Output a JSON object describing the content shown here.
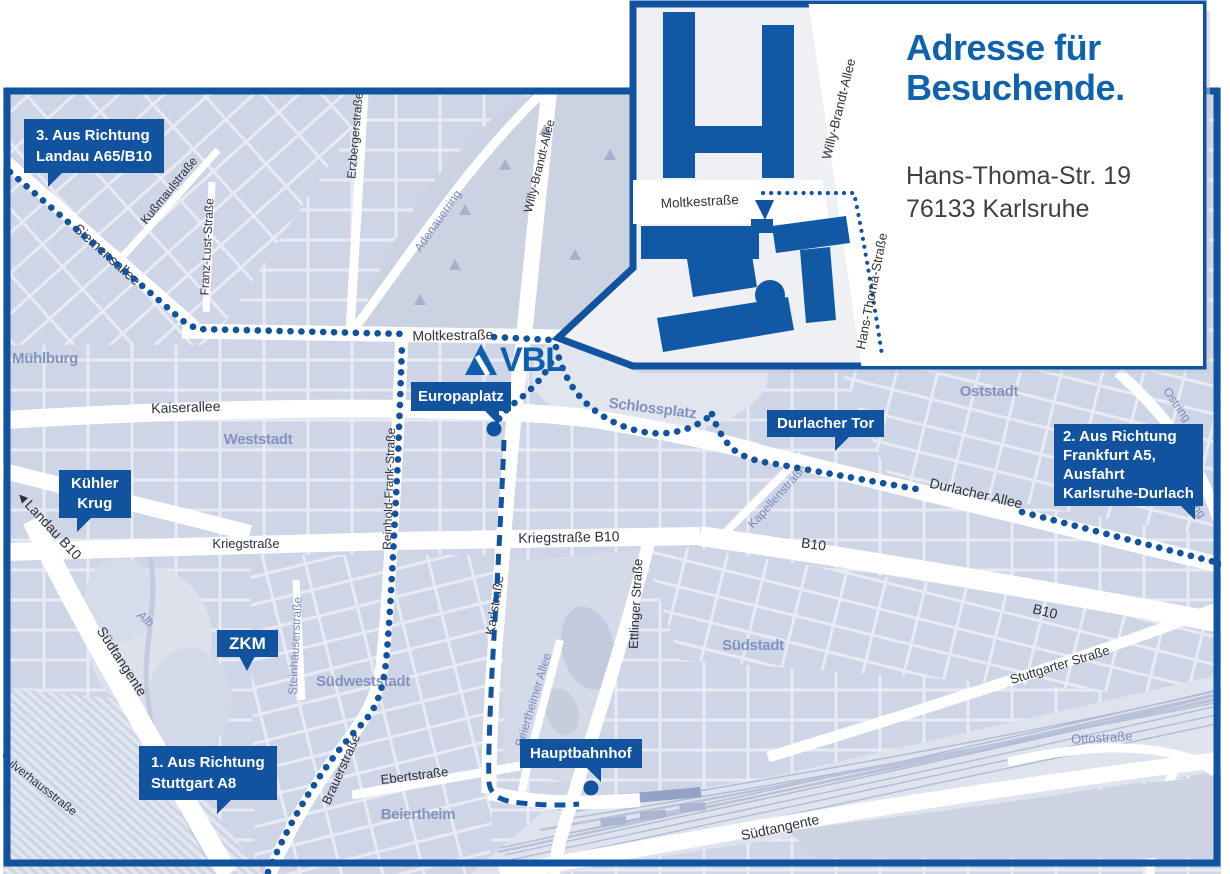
{
  "inset": {
    "title": {
      "line1": "Adresse für",
      "line2": "Besuchende."
    },
    "address": {
      "line1": "Hans-Thoma-Str. 19",
      "line2": "76133 Karlsruhe"
    },
    "streets": {
      "moltkestrasse": "Moltkestraße",
      "willy_brandt_allee": "Willy-Brandt-Allee",
      "hans_thoma_strasse": "Hans-Thoma-Straße"
    }
  },
  "logo": {
    "text": "VBL"
  },
  "callouts": {
    "landau": {
      "line1": "3. Aus Richtung",
      "line2": "Landau A65/B10"
    },
    "frankfurt": {
      "line1": "2. Aus Richtung",
      "line2": "Frankfurt A5,",
      "line3": "Ausfahrt",
      "line4": "Karlsruhe-Durlach"
    },
    "stuttgart": {
      "line1": "1. Aus Richtung",
      "line2": "Stuttgart A8"
    },
    "kuehler_krug": {
      "line1": "Kühler",
      "line2": "Krug"
    },
    "zkm": {
      "label": "ZKM"
    },
    "europaplatz": {
      "label": "Europaplatz"
    },
    "durlacher_tor": {
      "label": "Durlacher Tor"
    },
    "hauptbahnhof": {
      "label": "Hauptbahnhof"
    }
  },
  "streets": {
    "moltkestrasse": "Moltkestraße",
    "kaiserallee": "Kaiserallee",
    "siemensallee": "Siemensallee",
    "kussmaulstrasse": "Kußmaulstraße",
    "franz_lust_strasse": "Franz-Lust-Straße",
    "erzbergerstrasse": "Erzbergerstraße",
    "willy_brandt_allee": "Willy-Brandt-Allee",
    "adenauerring": "Adenauerring",
    "reinhold_frank_strasse": "Reinhold-Frank-Straße",
    "kriegstrasse": "Kriegstraße",
    "kriegstrasse_b10": "Kriegstraße B10",
    "karlstrasse": "Karlstraße",
    "ettlinger_strasse": "Ettlinger Straße",
    "beiertheimer_allee": "Beiertheimer Allee",
    "steinhaeuserstrasse": "Steinhäuserstraße",
    "brauerstrasse": "Brauerstraße",
    "ebertstrasse": "Ebertstraße",
    "suedtangente": "Südtangente",
    "stuttgarter_strasse": "Stuttgarter Straße",
    "durlacher_allee": "Durlacher Allee",
    "kapellenstrasse": "Kapellenstraße",
    "landau_b10": "◄Landau B10",
    "b10": "B10",
    "ostring": "Ostring",
    "ottostrasse": "Ottostraße",
    "alb": "Alb",
    "pulverhausstrasse": "Pulverhausstraße",
    "schlossplatz": "Schlossplatz"
  },
  "districts": {
    "muehlburg": "Mühlburg",
    "weststadt": "Weststadt",
    "oststadt": "Oststadt",
    "suedstadt": "Südstadt",
    "suedweststadt": "Südweststadt",
    "beiertheim": "Beiertheim"
  },
  "colors": {
    "primary_blue": "#11539f",
    "logo_blue": "#0d5fad",
    "title_blue": "#0f63ad",
    "map_background": "#e8ebf3",
    "block_fill": "#ced5e6",
    "district_label": "#8392be",
    "street_label": "#2e3138",
    "blue_street_label": "#7b8cbd",
    "address_text": "#3e4044"
  }
}
